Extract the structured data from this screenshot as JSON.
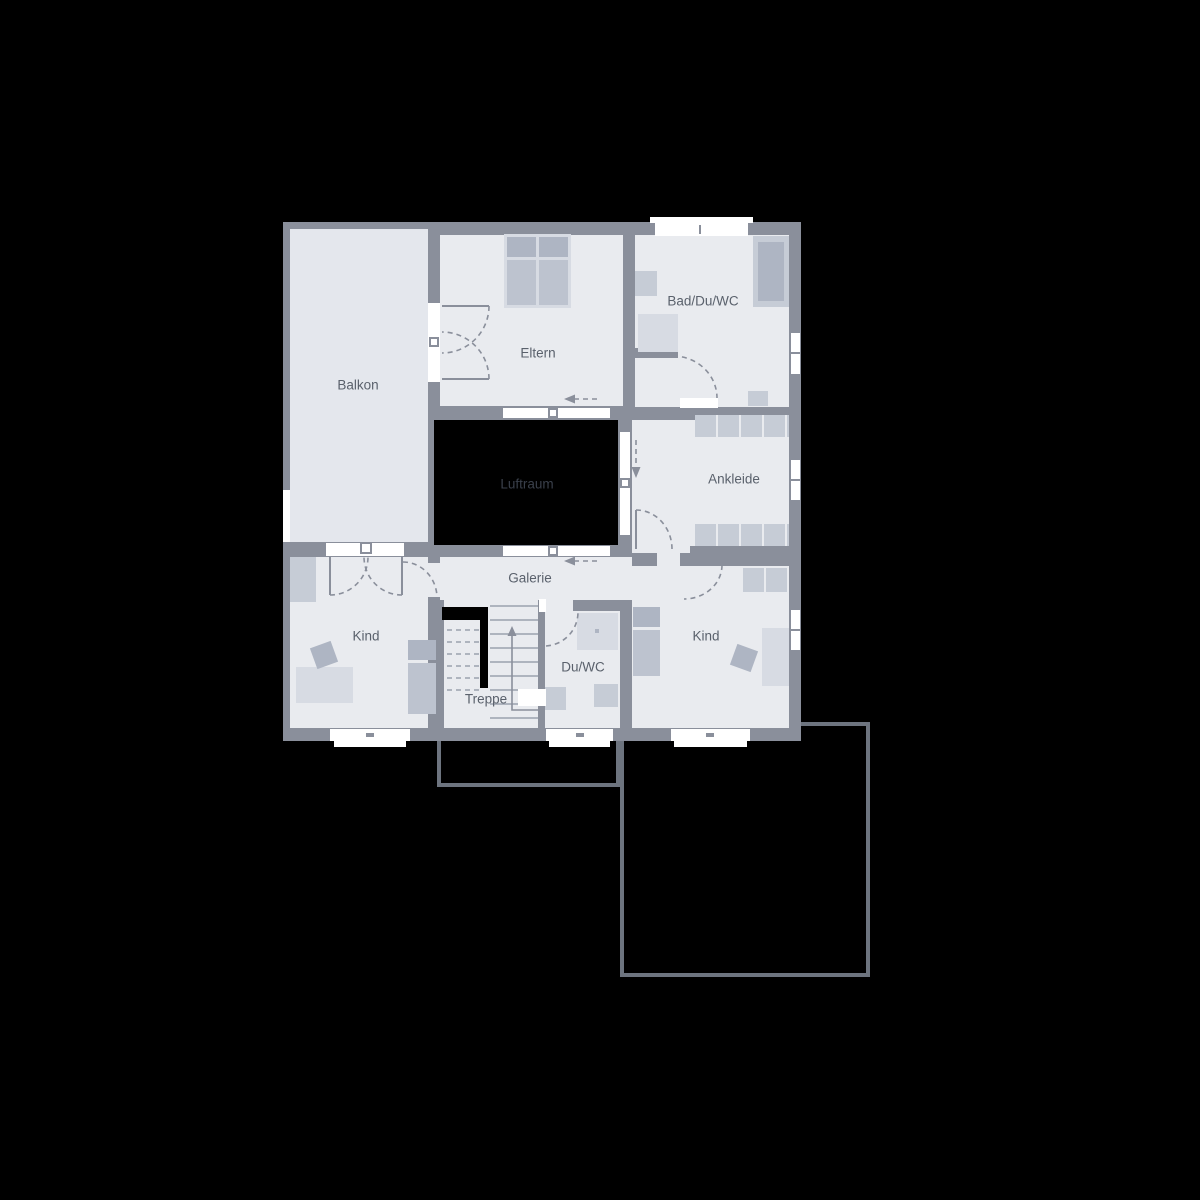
{
  "rooms": {
    "balkon": "Balkon",
    "eltern": "Eltern",
    "bad": "Bad/Du/WC",
    "ankleide": "Ankleide",
    "luftraum": "Luftraum",
    "galerie": "Galerie",
    "kind_left": "Kind",
    "kind_right": "Kind",
    "treppe": "Treppe",
    "duwc": "Du/WC"
  },
  "icons": {
    "arrow_left_galerie": "dashed-arrow-left",
    "arrow_left_eltern": "dashed-arrow-left",
    "arrow_down_corridor": "dashed-arrow-down",
    "arrow_up_stairs": "stair-direction-arrow-up"
  },
  "colors": {
    "bg": "#000000",
    "wall": "#8a8f9b",
    "floor": "#e9ebef",
    "balcony": "#e4e7ed",
    "void": "#000000",
    "white": "#ffffff",
    "furn_light": "#d7dbe3",
    "furn_base": "#c6ccd6",
    "furn_mid": "#bdc3cf",
    "furn_dark": "#aeb5c3",
    "label": "#5a616c",
    "label_dark": "#3a404b",
    "outline": "#6d747f",
    "tread": "#9aa1ad"
  }
}
